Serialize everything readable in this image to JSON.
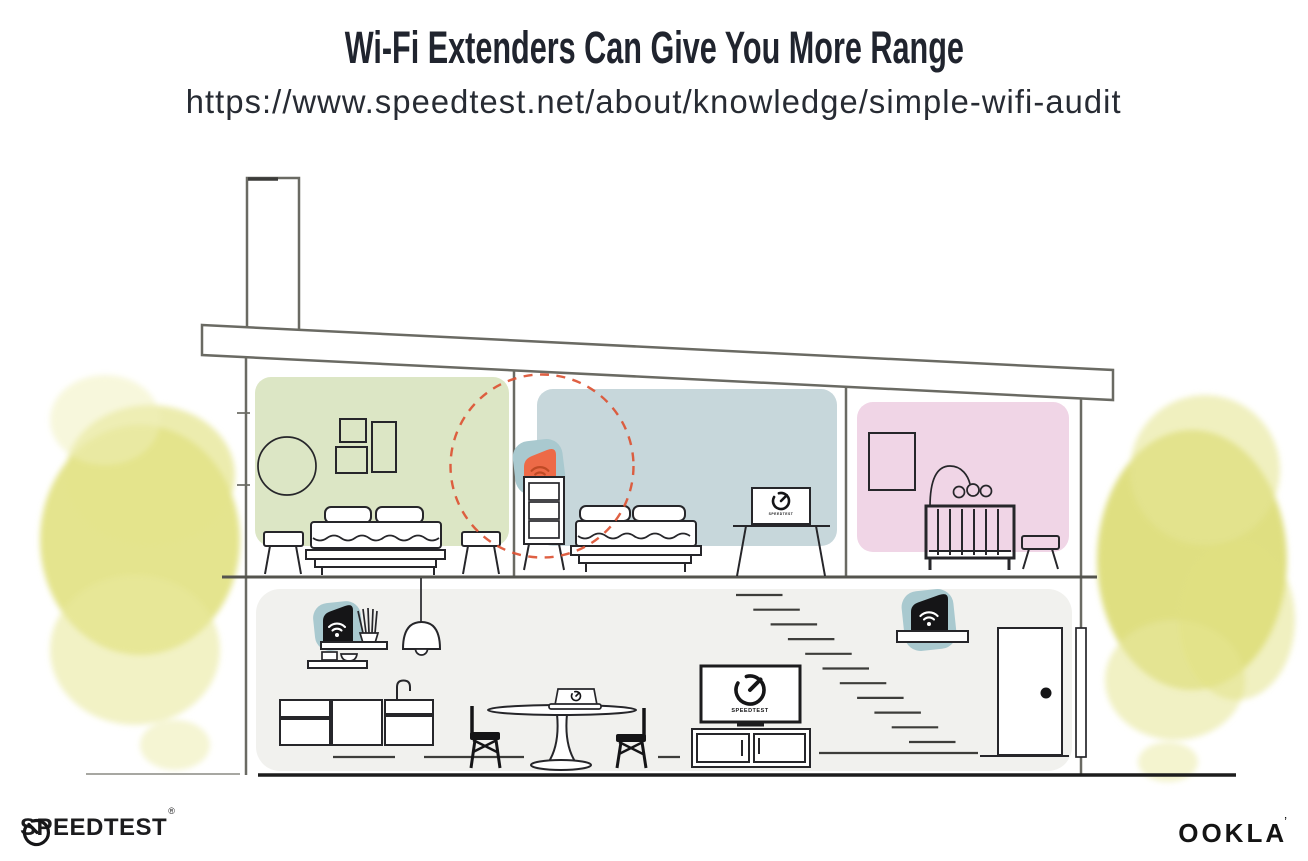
{
  "header": {
    "title": "Wi-Fi Extenders Can Give You More Range",
    "url": "https://www.speedtest.net/about/knowledge/simple-wifi-audit"
  },
  "screens": {
    "label": "SPEEDTEST"
  },
  "footer": {
    "speedtest_wordmark": "SPEEDTEST",
    "registered_mark": "®",
    "ookla_wordmark": "OOKLA",
    "ookla_tick": "’"
  },
  "colors": {
    "ink": "#20242e",
    "line_structure": "#6a6a63",
    "line_furniture": "#26262a",
    "room_green": "#dce6c5",
    "room_blue": "#c7d7db",
    "room_pink": "#f0d5e6",
    "room_gray": "#f1f1ee",
    "foliage_yellow": "#dfdf7a",
    "device_teal": "#a9c9cf",
    "extender_orange": "#ed6a47",
    "wifi_on_orange": "#bf4a25",
    "signal_red": "#dc5233",
    "device_black": "#151517"
  }
}
